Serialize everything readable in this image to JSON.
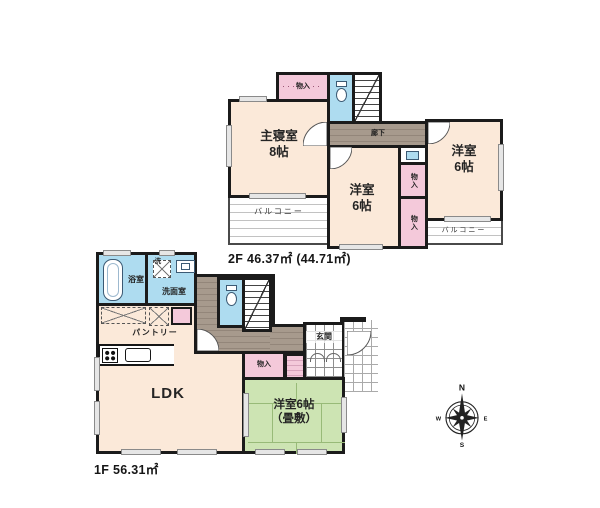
{
  "floor2": {
    "area_label": "2F 46.37㎡ (44.71㎡)",
    "master_bedroom": {
      "name": "主寝室",
      "size": "8帖"
    },
    "western_room_center": {
      "name": "洋室",
      "size": "6帖"
    },
    "western_room_right": {
      "name": "洋室",
      "size": "6帖"
    },
    "hallway": "廊下",
    "storage": "物入",
    "balcony": "バルコニー"
  },
  "floor1": {
    "area_label": "1F 56.31㎡",
    "bathroom": "浴室",
    "washroom": "洗面室",
    "laundry_mark": "洗",
    "pantry": "パントリー",
    "ldk": "LDK",
    "storage": "物入",
    "entrance": "玄関",
    "tatami_room_line1": "洋室6帖",
    "tatami_room_line2": "（畳敷）"
  },
  "compass": {
    "north": "N",
    "east": "E",
    "south": "S",
    "west": "W"
  },
  "colors": {
    "room_cream": "#fbe9d9",
    "storage_pink": "#f4c9da",
    "wet_blue": "#aedcf0",
    "tatami_green": "#cde4b3",
    "hallway_brown": "#a79a8d",
    "wall": "#1b1b1b"
  }
}
